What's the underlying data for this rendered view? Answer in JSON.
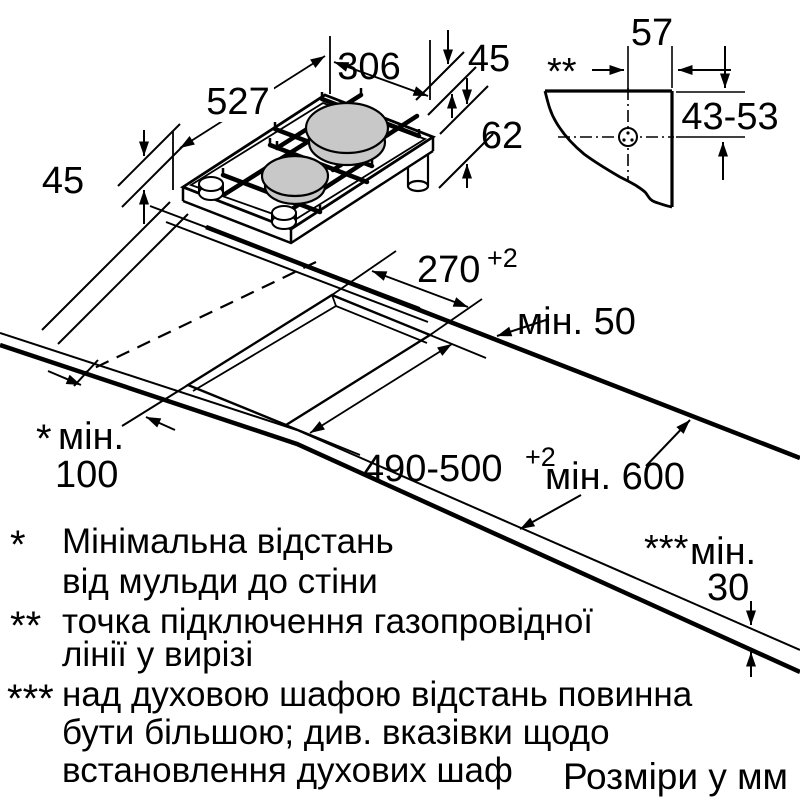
{
  "colors": {
    "line": "#000000",
    "burner_fill": "#c8c8c8",
    "background": "#ffffff"
  },
  "hob_view": {
    "dim_length": "527",
    "dim_width": "306",
    "dim_height_above": "45",
    "dim_left_height": "45",
    "dim_total_depth": "62"
  },
  "corner_detail": {
    "marker": "**",
    "dim_to_edge": "57",
    "dim_range": "43-53"
  },
  "worktop": {
    "dim_cutout_width": "270",
    "dim_cutout_width_tol": "+2",
    "dim_cutout_length": "490-500",
    "dim_cutout_length_tol": "+2",
    "min_rear": "мін. 50",
    "min_depth": "мін. 600",
    "min_wall_marker": "*",
    "min_wall_label": "мін.",
    "min_wall_value": "100",
    "min_thickness_marker": "***",
    "min_thickness_label": "мін.",
    "min_thickness_value": "30"
  },
  "footnotes": [
    {
      "marker": "*",
      "lines": [
        "Мінімальна відстань",
        "від мульди до стіни"
      ]
    },
    {
      "marker": "**",
      "lines": [
        "точка підключення газопровідної",
        "лінії у вирізі"
      ]
    },
    {
      "marker": "***",
      "lines": [
        "над духовою шафою відстань повинна",
        "бути більшою; див. вказівки щодо",
        "встановлення духових шаф"
      ]
    }
  ],
  "units_note": "Розміри у мм"
}
